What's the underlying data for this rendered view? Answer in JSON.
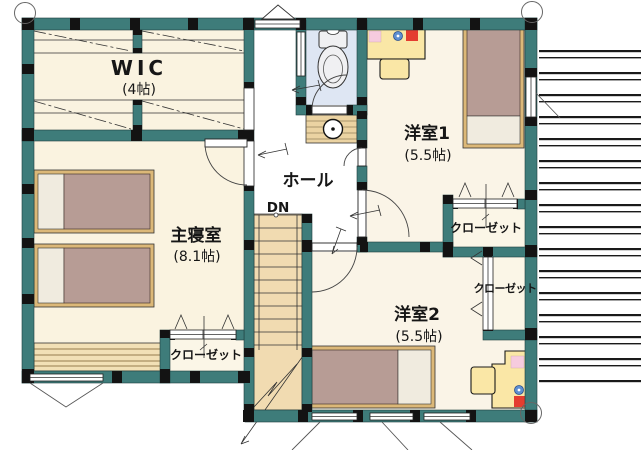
{
  "plan": {
    "rooms": {
      "wic": {
        "name": "WIC",
        "size": "(4帖)"
      },
      "master_bedroom": {
        "name": "主寝室",
        "size": "(8.1帖)"
      },
      "hall": {
        "name": "ホール"
      },
      "western_room_1": {
        "name": "洋室1",
        "size": "(5.5帖)"
      },
      "western_room_2": {
        "name": "洋室2",
        "size": "(5.5帖)"
      }
    },
    "closets": {
      "master": "クローゼット",
      "west1": "クローゼット",
      "west2": "クローゼット"
    },
    "stairs": {
      "direction_label": "DN"
    },
    "colors": {
      "wall": "#3E7C7A",
      "floor_cream": "#FAF3E0",
      "hall_white": "#FFFFFF",
      "toilet_floor": "#DEE6F3",
      "stairs_tan": "#F1DBB1",
      "bed_blanket": "#B79C95",
      "furniture_wood": "#DCB878",
      "desk_yellow": "#FAE7A6",
      "accent_pink": "#F6CBDE",
      "accent_red": "#E43D30",
      "accent_blue": "#5E8FD1"
    }
  }
}
